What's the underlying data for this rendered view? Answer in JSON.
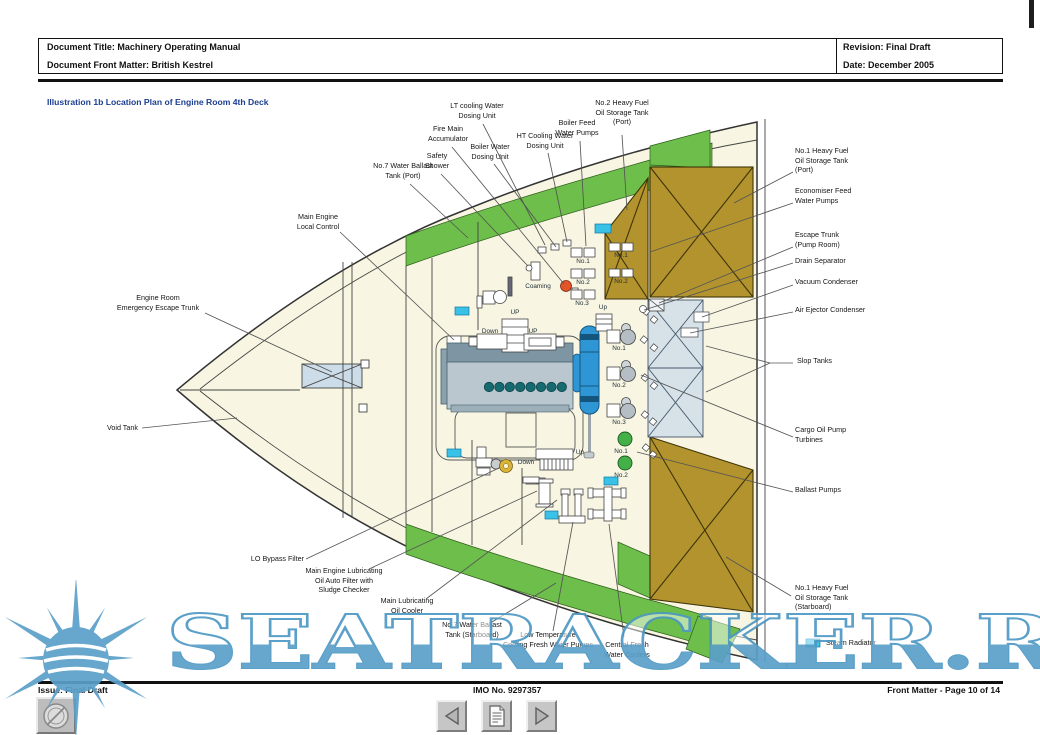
{
  "header": {
    "title_row": "Document Title: Machinery Operating Manual",
    "front_matter_row": "Document Front Matter: British Kestrel",
    "revision": "Revision: Final Draft",
    "date": "Date: December 2005"
  },
  "illustration_title": "Illustration 1b Location Plan of Engine Room 4th Deck",
  "callouts": {
    "lt_cooling_water_dosing_unit": "LT cooling Water\nDosing Unit",
    "fire_main_accumulator": "Fire Main\nAccumulator",
    "boiler_water_dosing_unit": "Boiler Water\nDosing Unit",
    "ht_cooling_water_dosing_unit": "HT Cooling Water\nDosing Unit",
    "boiler_feed_water_pumps": "Boiler Feed\nWater Pumps",
    "no2_hfo_port": "No.2 Heavy Fuel\nOil Storage Tank\n(Port)",
    "safety_shower": "Safety\nShower",
    "no7_wb_port": "No.7 Water Ballast\nTank (Port)",
    "main_engine_local_control": "Main Engine\nLocal Control",
    "engine_room_emergency_escape_trunk": "Engine Room\nEmergency Escape Trunk",
    "void_tank": "Void Tank",
    "no1_hfo_port": "No.1 Heavy Fuel\nOil Storage Tank\n(Port)",
    "economiser_feed_water_pumps": "Economiser Feed\nWater Pumps",
    "escape_trunk_pump_room": "Escape Trunk\n(Pump Room)",
    "drain_separator": "Drain Separator",
    "vacuum_condenser": "Vacuum Condenser",
    "air_ejector_condenser": "Air Ejector Condenser",
    "slop_tanks": "Slop Tanks",
    "cargo_oil_pump_turbines": "Cargo Oil Pump\nTurbines",
    "ballast_pumps": "Ballast Pumps",
    "no1_hfo_starboard": "No.1 Heavy Fuel\nOil Storage Tank\n(Starboard)",
    "steam_radiator": "Steam Radiator",
    "lo_bypass_filter": "LO Bypass Filter",
    "me_lo_auto_filter": "Main Engine Lubricating\nOil Auto Filter with\nSludge Checker",
    "main_lo_cooler": "Main Lubricating\nOil Cooler",
    "no7_wb_starboard": "No.7 Water Ballast\nTank (Starboard)",
    "lt_cooling_fw_pumps": "Low Temperature\nCooling Fresh Water Pumps",
    "central_fw_coolers": "Central Fresh\nWater Coolers"
  },
  "plan_labels": {
    "coaming": "Coaming",
    "stair_up_1": "UP",
    "stair_down_1": "Down",
    "stair_up_2": "UP",
    "stair_up_3": "Up",
    "stair_up_4": "Up",
    "stair_down_2": "Down",
    "bfw_pumps": [
      "No.1",
      "No.2",
      "No.3"
    ],
    "econ_pumps": [
      "No.1",
      "No.2"
    ],
    "cop_turbines": [
      "No.1",
      "No.2",
      "No.3"
    ],
    "ballast_pumps": [
      "No.1",
      "No.2"
    ]
  },
  "footer": {
    "issue": "Issue: Final Draft",
    "imo": "IMO No. 9297357",
    "page": "Front Matter - Page 10 of 14"
  },
  "watermark": {
    "text": "SEATRACKER.RU"
  },
  "icons": {
    "prev": "left-triangle",
    "contents": "document-sheet",
    "next": "right-triangle",
    "logo": "compass-circle",
    "sun": "sun-rays"
  },
  "colors": {
    "deck_cream": "#f8f6e2",
    "ballast_green": "#6dbe4b",
    "fuel_tan": "#b2932e",
    "slop_gray": "#d6e1e8",
    "radiator_cyan": "#39c1e8",
    "title_blue": "#1c3e91",
    "watermark_blue": "#5ba0c9"
  }
}
